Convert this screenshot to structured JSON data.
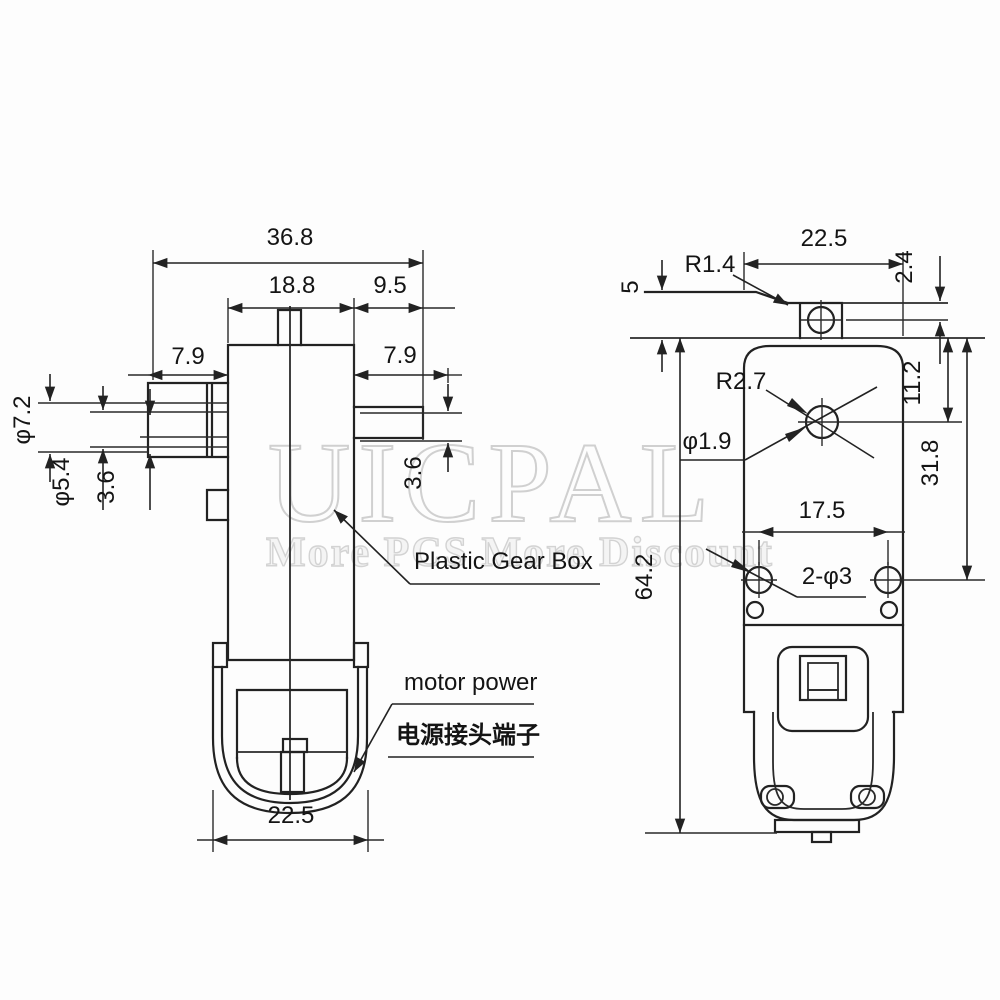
{
  "drawing": {
    "title": "Plastic gear motor dimensional drawing",
    "watermark": {
      "brand": "UICPAL",
      "tagline": "More PCS More Discount"
    },
    "side_view": {
      "dim_total_width": "36.8",
      "dim_gearbox_width": "18.8",
      "dim_right_step": "9.5",
      "dim_shaft_left_length": "7.9",
      "dim_shaft_right_length": "7.9",
      "dim_shaft_outer_dia": "φ7.2",
      "dim_shaft_mid_dia": "φ5.4",
      "dim_shaft_flat_left": "3.6",
      "dim_shaft_flat_right": "3.6",
      "dim_motor_width": "22.5",
      "label_gearbox": "Plastic Gear Box",
      "label_motor_power_en": "motor power",
      "label_motor_power_cn": "电源接头端子"
    },
    "rear_view": {
      "dim_body_width": "22.5",
      "dim_tab_fillet": "R1.4",
      "dim_hole_offset": "2.4",
      "dim_tab_height": "5",
      "dim_corner_radius": "R2.7",
      "dim_shaft_hole_dia": "φ1.9",
      "dim_hole_to_top": "11.2",
      "dim_holes_to_top": "31.8",
      "dim_hole_spacing": "17.5",
      "dim_mount_holes": "2-φ3",
      "dim_total_height": "64.2"
    }
  }
}
